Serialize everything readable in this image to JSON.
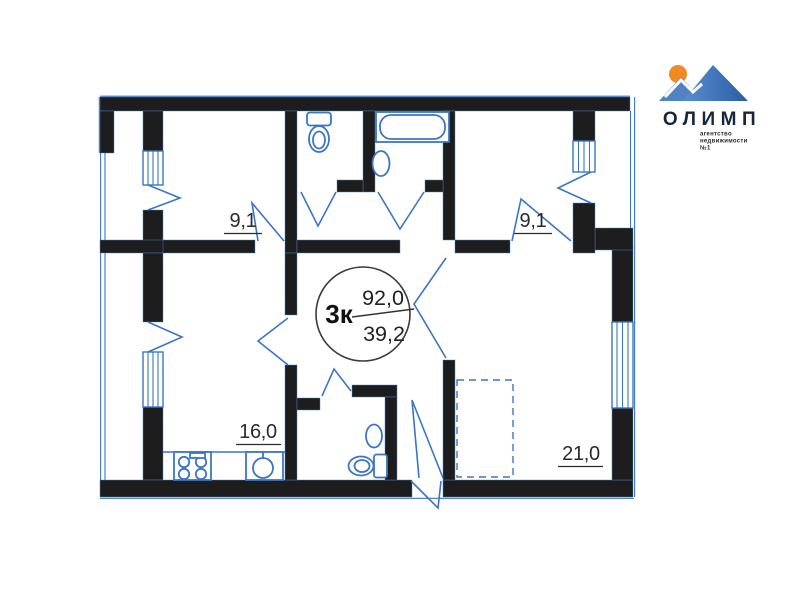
{
  "logo": {
    "name": "ОЛИМП",
    "tagline": [
      "агентство",
      "недвижимости",
      "№1"
    ],
    "colors": {
      "sun": "#F08A21",
      "mountain_light": "#4F83C4",
      "mountain_dark": "#2A5CA6",
      "wordmark": "#17263F"
    }
  },
  "plan": {
    "type_badge": {
      "rooms_label": "3к",
      "total_area": "92,0",
      "living_area": "39,2"
    },
    "rooms": [
      {
        "name": "room-top-left",
        "area_label": "9,1"
      },
      {
        "name": "room-top-right",
        "area_label": "9,1"
      },
      {
        "name": "kitchen",
        "area_label": "16,0"
      },
      {
        "name": "living-room",
        "area_label": "21,0"
      }
    ],
    "colors": {
      "walls": "#1D1D1D",
      "lines": "#3A76C4",
      "labels": "#2B2B2B"
    }
  }
}
